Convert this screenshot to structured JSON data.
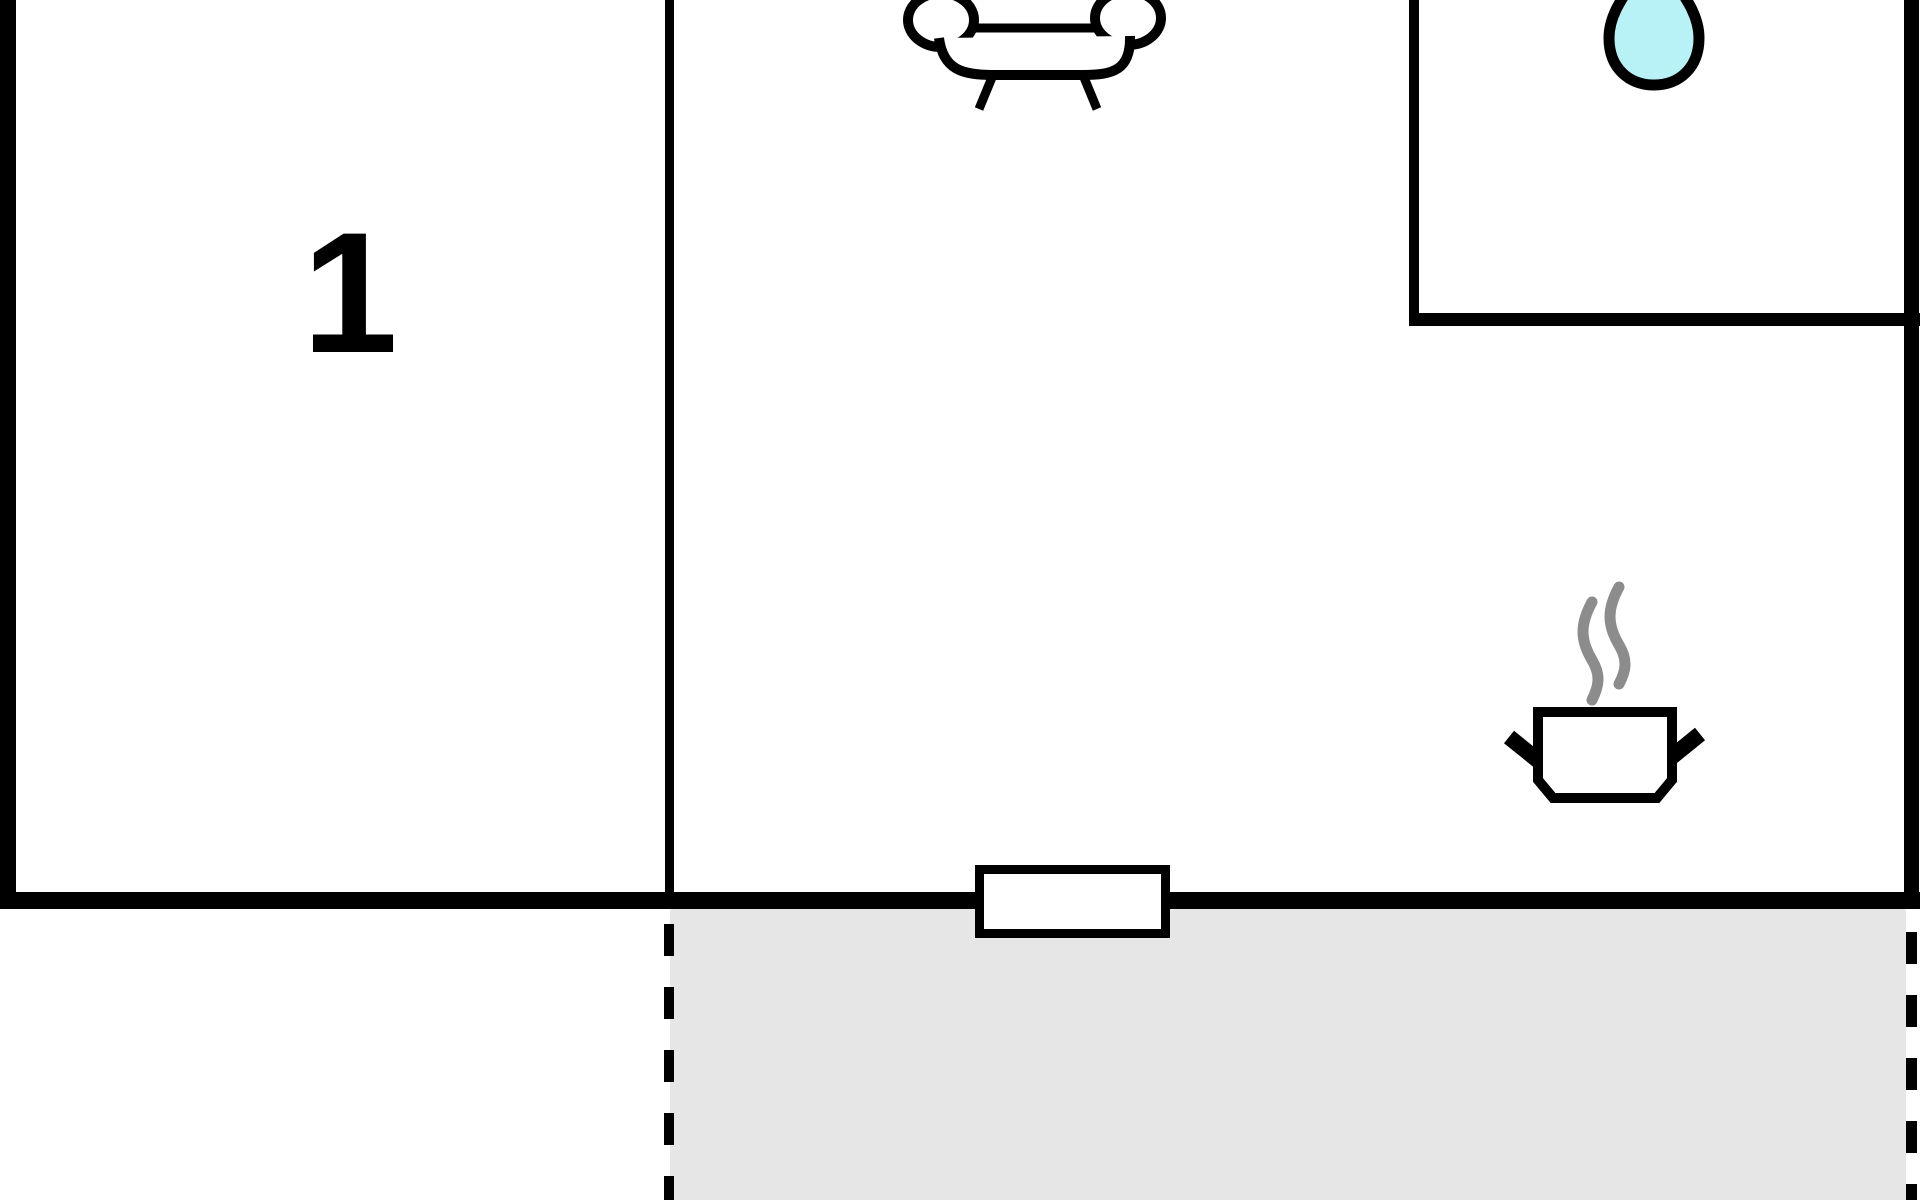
{
  "plan": {
    "type": "apartment-floor-plan",
    "rooms": {
      "room1": {
        "label": "1"
      },
      "living_kitchen": {
        "icons": [
          "sofa-icon",
          "cooking-pot-icon"
        ]
      },
      "bathroom": {
        "icons": [
          "water-drop-icon"
        ]
      },
      "terrace": {
        "style": "gray-hatched-area",
        "boundary": "dashed"
      }
    },
    "features": {
      "window_in_bottom_wall": true
    },
    "colors": {
      "background": "#ffffff",
      "wall": "#000000",
      "terrace_fill": "#e6e6e6",
      "water_drop_fill": "#b8f1f6",
      "steam": "#8c8c8c",
      "window_fill": "#ffffff"
    }
  }
}
